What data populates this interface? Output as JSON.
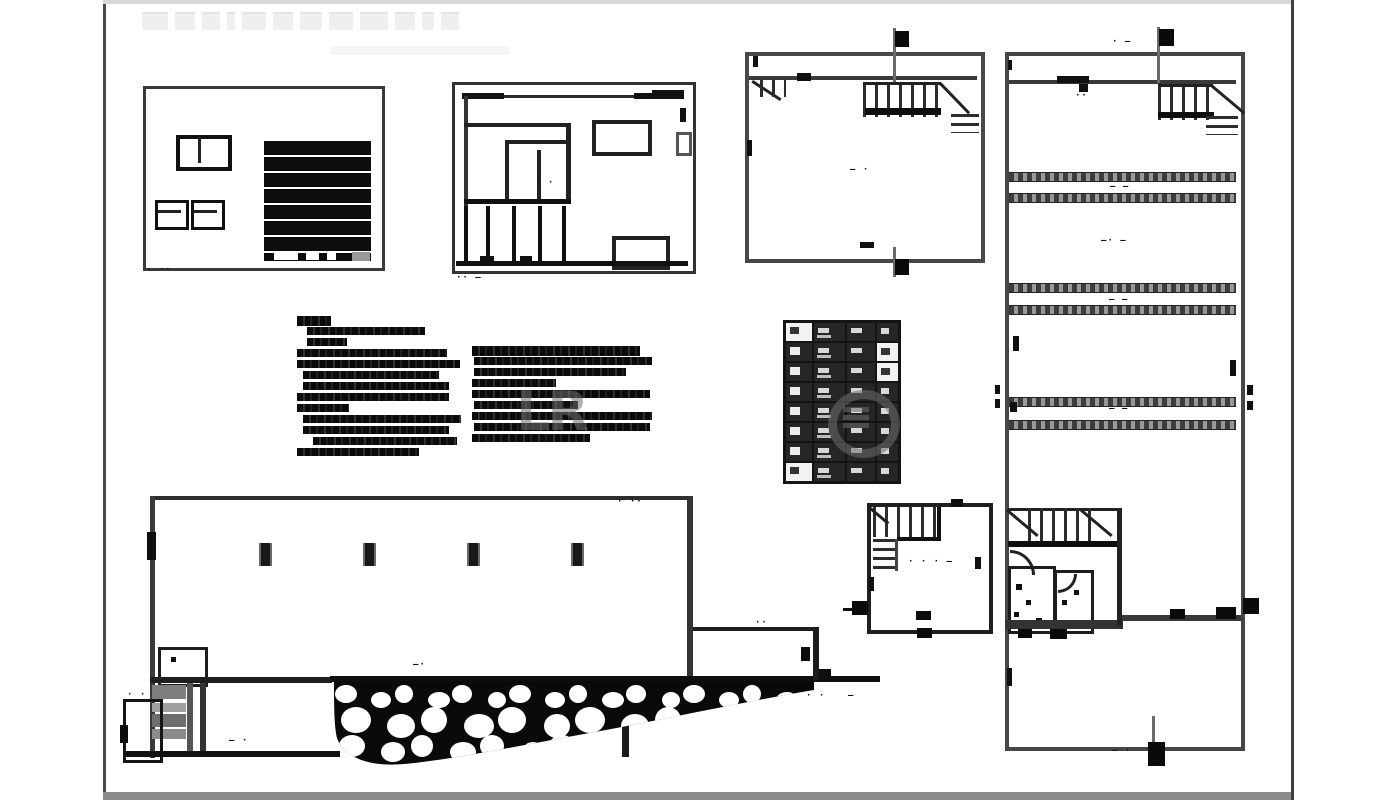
{
  "page": {
    "bg": "#ffffff",
    "top_band_color": "#d6d6d6",
    "bottom_band_color": "#8c8c8c",
    "frame_color": "#4a4a4a",
    "ink": "#1c1c1c",
    "ghost_title_blocks": [
      26,
      20,
      18,
      8,
      24,
      20,
      22,
      24,
      28,
      20,
      12,
      18
    ]
  },
  "captions": {
    "front_elevation": "· ··",
    "cross_section": "·· –",
    "section_inner": "· ·",
    "plan_upper_center": "– ·",
    "tall_top": "· –",
    "tall_door": "··",
    "tall_room1": "– —",
    "tall_room2": "–· —",
    "tall_room3": "– —",
    "tall_room4": "– —",
    "tall_bottom": "– ·",
    "small_plan_center": "· · · –",
    "elev_top": "· ··",
    "elev_stone": "–·",
    "elev_room": "– ·",
    "elev_ground_a": "· ·",
    "elev_ground_b": "–",
    "elev_annex": "··",
    "elev_basement": "· ·"
  },
  "views": {
    "front_elevation": {
      "garage_slats": 8,
      "windows": 3,
      "garage_bottom_slots": 3
    },
    "cross_section": {
      "door_jambs": 5
    },
    "floor_plan_upper": {
      "stair_treads": 8,
      "landing_lines": 3,
      "section_flags": 2
    },
    "tall_plan": {
      "stair_treads": 6,
      "bottom_stair_treads": 7,
      "band_ys": [
        172,
        193,
        283,
        305,
        397,
        420
      ],
      "section_flags": 2
    },
    "side_elevation": {
      "vent_xs": [
        259,
        363,
        467,
        571
      ],
      "vent_count": 4
    },
    "small_plan": {
      "stair_treads": 6,
      "side_treads": 4
    }
  },
  "notes_left": {
    "lines": [
      [
        0,
        34
      ],
      [
        10,
        118
      ],
      [
        10,
        40
      ],
      [
        0,
        150
      ],
      [
        0,
        163
      ],
      [
        6,
        136
      ],
      [
        6,
        146
      ],
      [
        0,
        152
      ],
      [
        0,
        52
      ],
      [
        6,
        158
      ],
      [
        6,
        146
      ],
      [
        16,
        144
      ],
      [
        0,
        122
      ]
    ]
  },
  "notes_right": {
    "lines": [
      [
        0,
        168
      ],
      [
        2,
        178
      ],
      [
        2,
        152
      ],
      [
        0,
        84
      ],
      [
        0,
        178
      ],
      [
        2,
        104
      ],
      [
        0,
        180
      ],
      [
        2,
        176
      ],
      [
        0,
        118
      ]
    ]
  },
  "schedule": {
    "col_widths": [
      26,
      31,
      28,
      21
    ],
    "rows": 8,
    "row_h": 18,
    "light_cells": [
      [
        0,
        0
      ],
      [
        1,
        3
      ],
      [
        2,
        3
      ],
      [
        7,
        0
      ]
    ]
  },
  "stone_wall": {
    "rows": [
      {
        "y": 16,
        "rx": 11,
        "ry": 9,
        "x0": 14,
        "dx": 29,
        "count": 16
      },
      {
        "y": 42,
        "rx": 15,
        "ry": 13,
        "x0": 24,
        "dx": 39,
        "count": 11
      },
      {
        "y": 68,
        "rx": 13,
        "ry": 11,
        "x0": 20,
        "dx": 35,
        "count": 7
      }
    ]
  },
  "watermark": {
    "text": "LR",
    "ring_bars": 3
  }
}
